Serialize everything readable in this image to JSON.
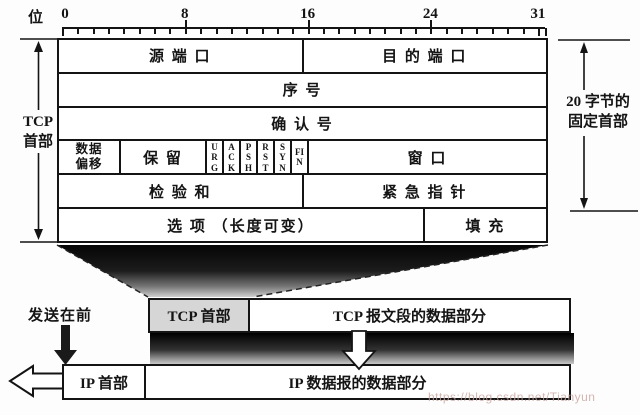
{
  "ruler": {
    "unit_label": "位",
    "numbers": [
      {
        "label": "0",
        "bit": 0
      },
      {
        "label": "8",
        "bit": 8
      },
      {
        "label": "16",
        "bit": 16
      },
      {
        "label": "24",
        "bit": 24
      },
      {
        "label": "31",
        "bit": 31
      }
    ]
  },
  "tcp_table": {
    "source_port": "源 端 口",
    "dest_port": "目 的 端 口",
    "seq_no": "序 号",
    "ack_no": "确 认 号",
    "data_offset_line1": "数据",
    "data_offset_line2": "偏移",
    "reserved": "保 留",
    "flags": [
      "URG",
      "ACK",
      "PSH",
      "RST",
      "SYN",
      "FIN"
    ],
    "window": "窗 口",
    "checksum": "检 验 和",
    "urgent_pointer": "紧 急 指 针",
    "options": "选 项 （长度可变）",
    "padding": "填 充"
  },
  "brackets": {
    "left_line1": "TCP",
    "left_line2": "首部",
    "right_line1": "20 字节的",
    "right_line2": "固定首部"
  },
  "bottom": {
    "sent_first": "发送在前",
    "tcp_bar_header": "TCP 首部",
    "tcp_bar_data": "TCP 报文段的数据部分",
    "ip_bar_header": "IP 首部",
    "ip_bar_data": "IP 数据报的数据部分"
  },
  "watermark": "https://blog.csdn.net/Tianyun",
  "colors": {
    "ink": "#141414",
    "tcp_header_cell_bg": "#d6d6d6",
    "shadow_dark": "#000000"
  }
}
